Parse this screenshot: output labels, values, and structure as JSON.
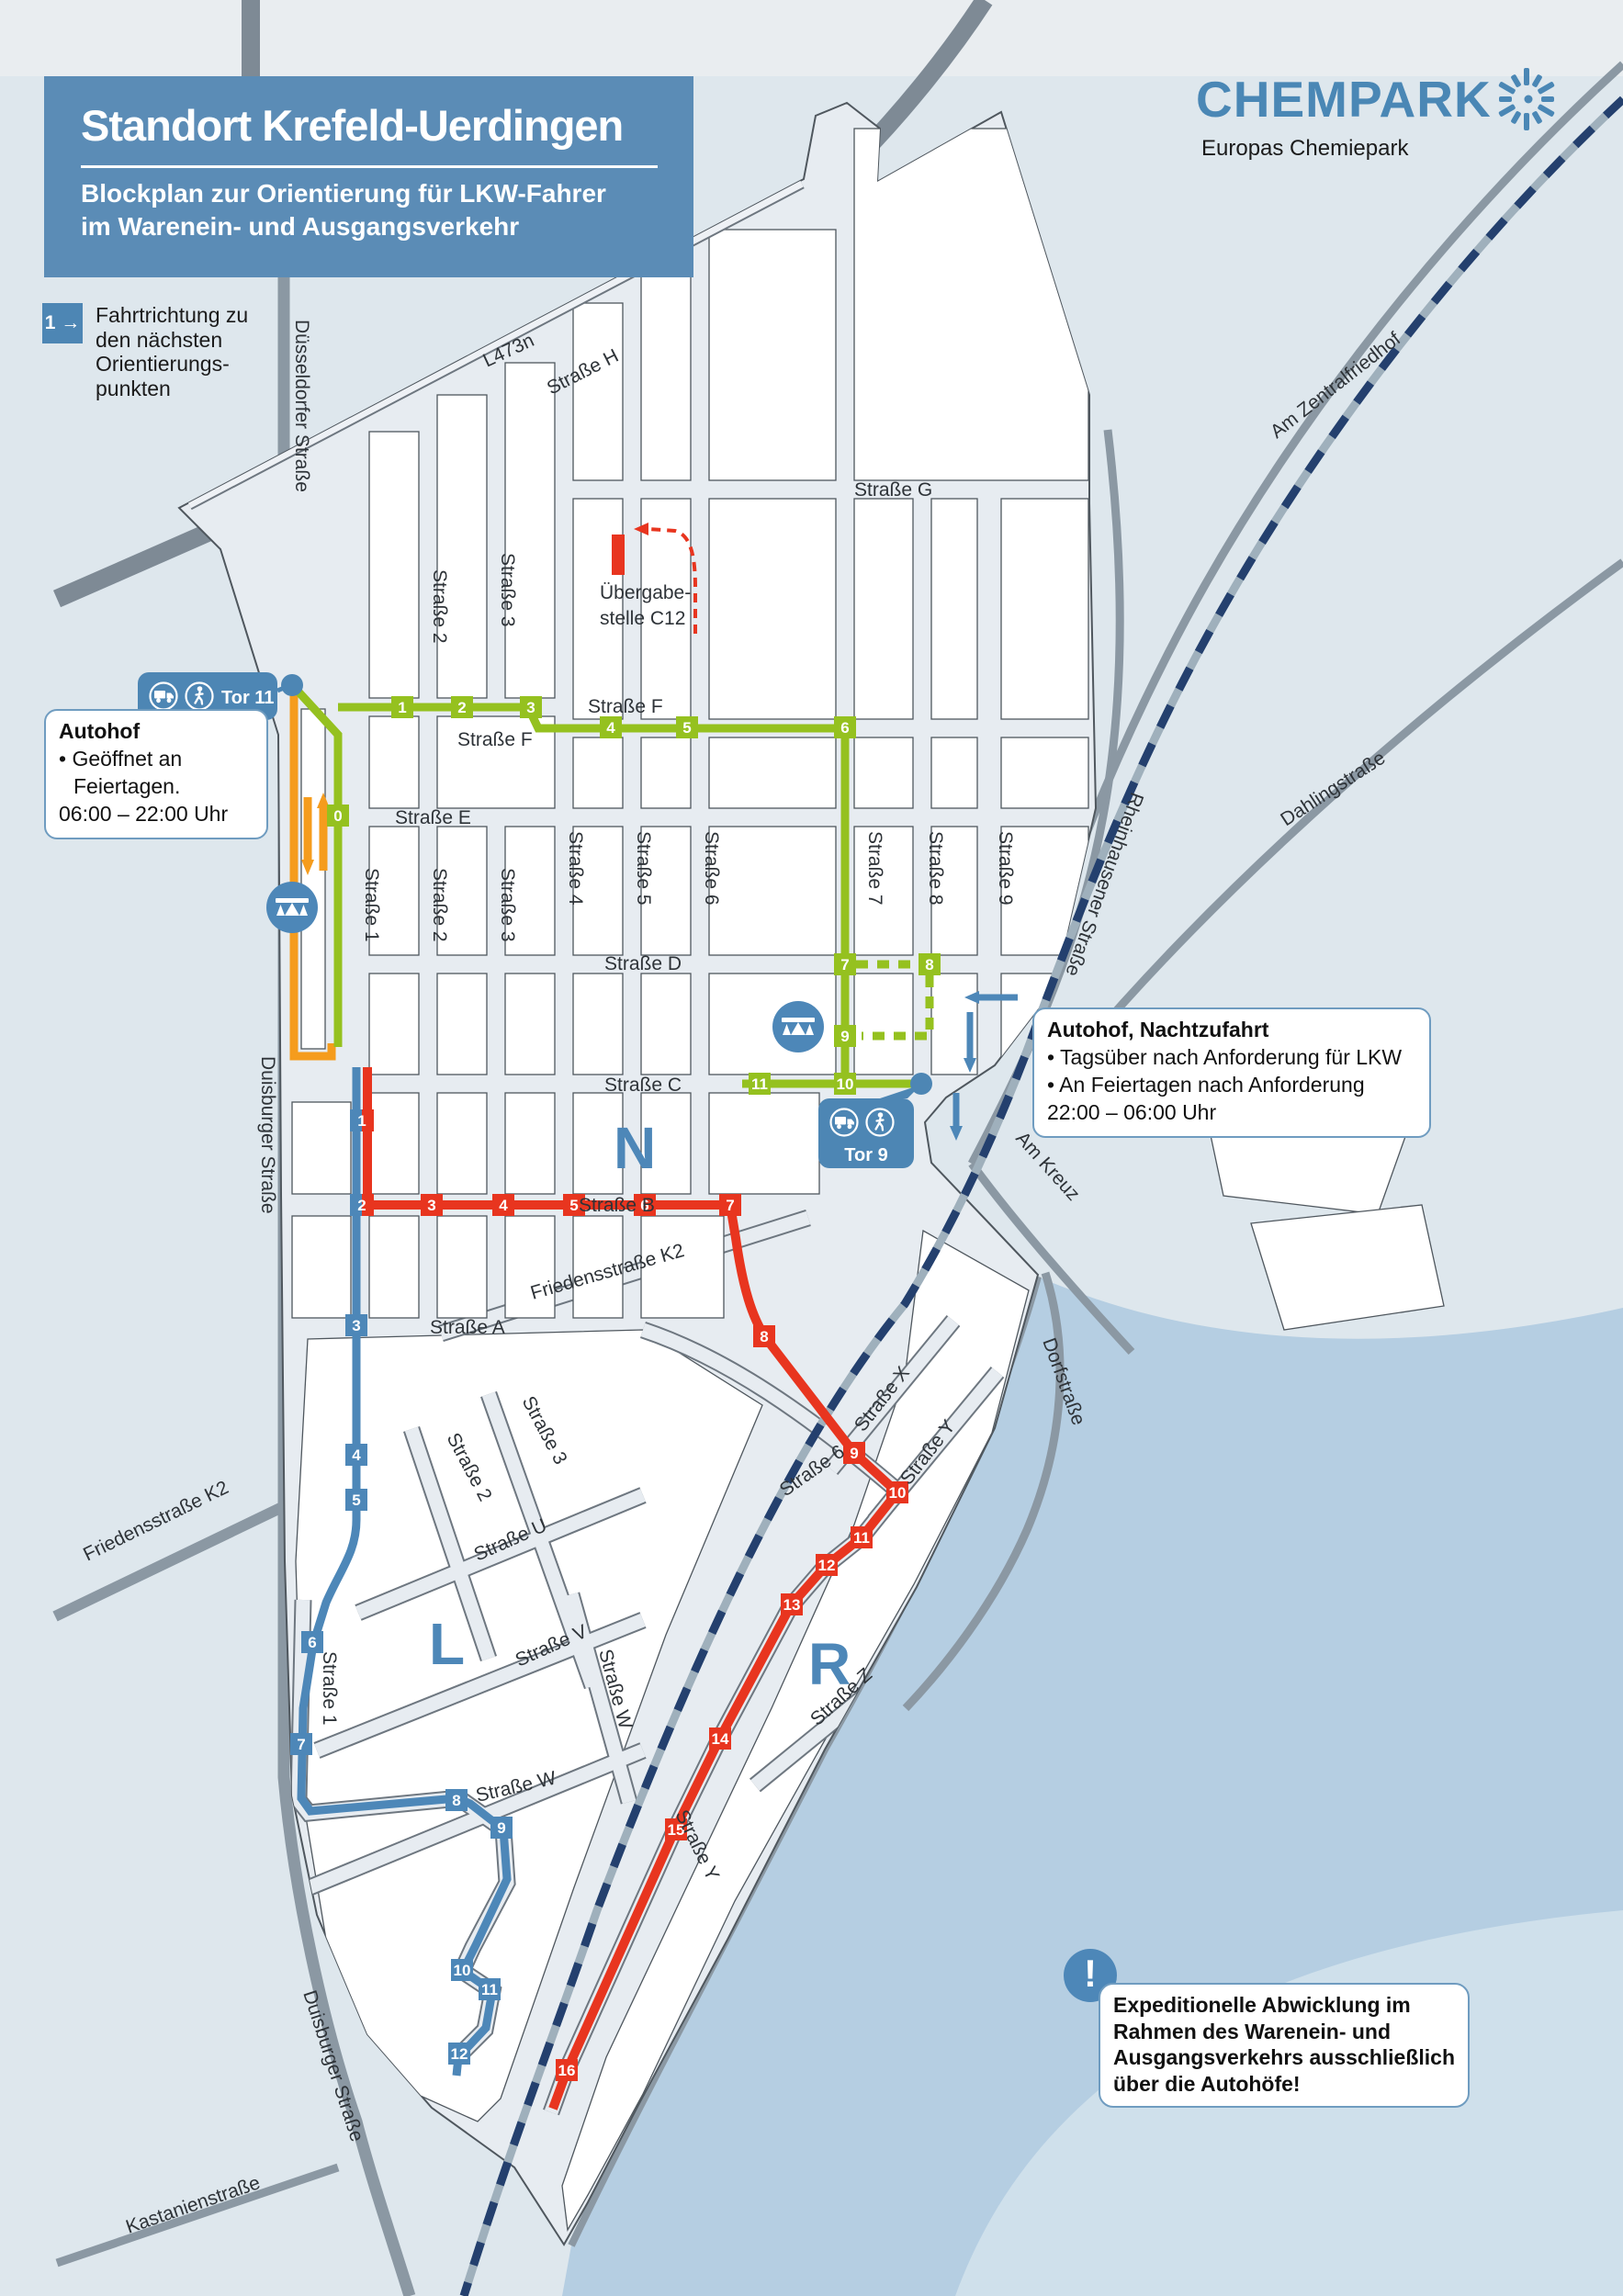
{
  "header": {
    "title": "Standort Krefeld-Uerdingen",
    "subtitle1": "Blockplan zur Orientierung für LKW-Fahrer",
    "subtitle2": "im Warenein- und Ausgangsverkehr"
  },
  "brand": {
    "name": "CHEMPARK",
    "tagline": "Europas Chemiepark"
  },
  "legend": {
    "badge": "1 →",
    "line1": "Fahrtrichtung zu",
    "line2": "den nächsten",
    "line3": "Orientierungs-",
    "line4": "punkten"
  },
  "gates": {
    "tor11": "Tor 11",
    "tor9": "Tor 9"
  },
  "boxes": {
    "autohof": {
      "title": "Autohof",
      "bullet": "• Geöffnet an Feiertagen.",
      "hours": "06:00 – 22:00 Uhr"
    },
    "nacht": {
      "title": "Autohof, Nachtzufahrt",
      "bullet1": "• Tagsüber nach Anforderung für LKW",
      "bullet2": "• An Feiertagen nach Anforderung",
      "hours": "22:00 – 06:00 Uhr"
    },
    "warning": {
      "icon": "!",
      "line1": "Expeditionelle Abwicklung im",
      "line2": "Rahmen des Warenein- und",
      "line3": "Ausgangsverkehrs ausschließlich",
      "line4": "über die Autohöfe!"
    }
  },
  "poi": {
    "uebergabe1": "Übergabe-",
    "uebergabe2": "stelle C12"
  },
  "districts": {
    "n": "N",
    "l": "L",
    "r": "R"
  },
  "streets": {
    "duesseldorfer": "Düsseldorfer Straße",
    "l473n": "L473n",
    "h": "Straße H",
    "g": "Straße G",
    "f": "Straße F",
    "e": "Straße E",
    "d": "Straße D",
    "c": "Straße C",
    "b": "Straße B",
    "a": "Straße A",
    "s1": "Straße 1",
    "s2": "Straße 2",
    "s3": "Straße 3",
    "s4": "Straße 4",
    "s5": "Straße 5",
    "s6": "Straße 6",
    "s7": "Straße 7",
    "s8": "Straße 8",
    "s9": "Straße 9",
    "u": "Straße U",
    "v": "Straße V",
    "w": "Straße W",
    "x": "Straße X",
    "y": "Straße Y",
    "z": "Straße Z",
    "friedensstrasse": "Friedensstraße K2",
    "duisburger": "Duisburger Straße",
    "kastanien": "Kastanienstraße",
    "zentralfriedhof": "Am Zentralfriedhof",
    "dahling": "Dahlingstraße",
    "rheinhausener": "Rheinhausener Straße",
    "amkreuz": "Am Kreuz",
    "dorf": "Dorfstraße"
  },
  "routes": {
    "green": {
      "color": "#95c11f",
      "points": [
        "0",
        "1",
        "2",
        "3",
        "4",
        "5",
        "6",
        "7",
        "8",
        "9",
        "10",
        "11"
      ]
    },
    "shared_blue_red": {
      "points": [
        "1",
        "2"
      ]
    },
    "red": {
      "color": "#e8351f",
      "points": [
        "3",
        "4",
        "5",
        "6",
        "7",
        "8",
        "9",
        "10",
        "11",
        "12",
        "13",
        "14",
        "15",
        "16"
      ]
    },
    "blue": {
      "color": "#4d87b8",
      "points": [
        "3",
        "4",
        "5",
        "6",
        "7",
        "8",
        "9",
        "10",
        "11",
        "12"
      ]
    },
    "orange": {
      "color": "#f59c1d"
    }
  },
  "colors": {
    "header": "#5b8cb6",
    "brand": "#4a87b5",
    "gate": "#4d86b4",
    "rail": "#24406e",
    "road": "#8b98a3",
    "river": "#b5cee2",
    "site": "#e7ecf1",
    "block_outline": "#4f575e",
    "background": "#dee7ed"
  }
}
